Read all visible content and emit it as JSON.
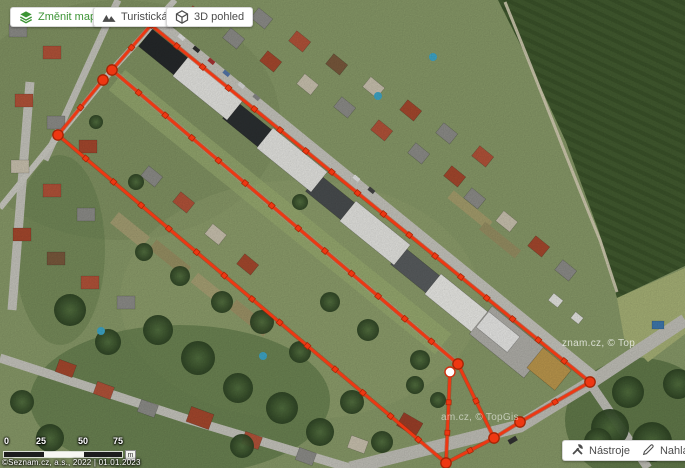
{
  "header": {
    "buttons": [
      {
        "label": "Změnit mapu",
        "icon": "layers-icon",
        "color": "#3c9435"
      },
      {
        "label": "Turistická",
        "icon": "mountains-icon",
        "color": "#4c4c4c"
      },
      {
        "label": "3D pohled",
        "icon": "cube-icon",
        "color": "#4c4c4c"
      }
    ]
  },
  "toolbar": {
    "tools_label": "Nástroje",
    "report_label": "Nahlásit chybu"
  },
  "scale": {
    "ticks": [
      "0",
      "25",
      "50",
      "75"
    ],
    "unit": "m"
  },
  "attribution": "©Seznam.cz, a.s., 2022 | 01.01.2023",
  "watermarks": [
    "znam.cz, © Top",
    "am.cz, © TopGis"
  ],
  "route": {
    "color": "#ee3712",
    "outline": "#a32405",
    "lines": [
      {
        "from": [
          151,
          25
        ],
        "to": [
          590,
          382
        ],
        "ticks": 16
      },
      {
        "from": [
          151,
          25
        ],
        "to": [
          112,
          70
        ],
        "ticks": 1
      },
      {
        "from": [
          112,
          70
        ],
        "to": [
          458,
          364
        ],
        "ticks": 12
      },
      {
        "from": [
          103,
          80
        ],
        "to": [
          58,
          135
        ],
        "ticks": 1
      },
      {
        "from": [
          58,
          135
        ],
        "to": [
          446,
          463
        ],
        "ticks": 13
      },
      {
        "from": [
          450,
          372
        ],
        "to": [
          446,
          463
        ],
        "ticks": 2
      },
      {
        "from": [
          458,
          364
        ],
        "to": [
          494,
          438
        ],
        "ticks": 1
      },
      {
        "from": [
          446,
          463
        ],
        "to": [
          494,
          438
        ],
        "ticks": 1
      },
      {
        "from": [
          494,
          438
        ],
        "to": [
          520,
          422
        ],
        "ticks": 0
      },
      {
        "from": [
          520,
          422
        ],
        "to": [
          590,
          382
        ],
        "ticks": 1
      }
    ],
    "corners": [
      [
        151,
        25
      ]
    ],
    "nodes": [
      [
        112,
        70
      ],
      [
        103,
        80
      ],
      [
        58,
        135
      ],
      [
        458,
        364
      ],
      [
        446,
        463
      ],
      [
        494,
        438
      ],
      [
        520,
        422
      ],
      [
        590,
        382
      ]
    ],
    "start_node": [
      450,
      372
    ]
  }
}
